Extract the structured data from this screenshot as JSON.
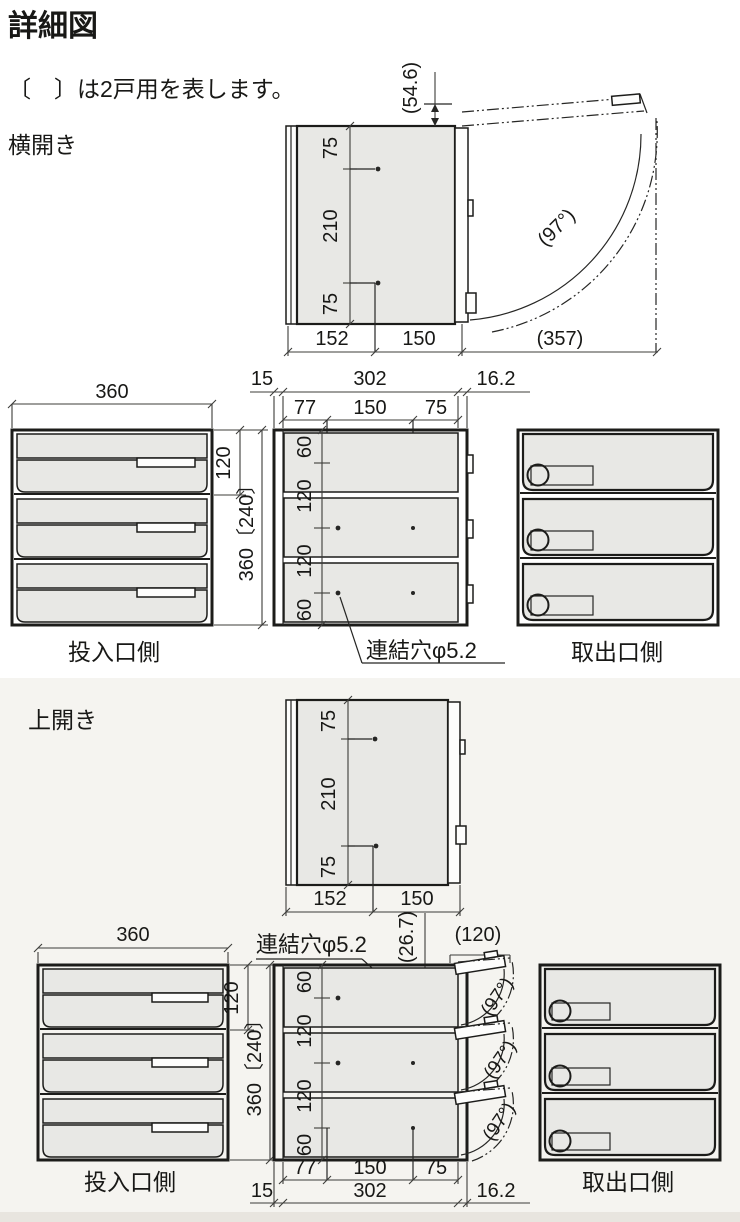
{
  "header": {
    "title": "詳細図",
    "note": "〔　〕は2戸用を表します。"
  },
  "sections": {
    "side_open": "横開き",
    "top_open": "上開き"
  },
  "labels": {
    "inlet_side": "投入口側",
    "outlet_side": "取出口側",
    "joint_hole": "連結穴φ5.2"
  },
  "dims": {
    "d54_6": "(54.6)",
    "d75": "75",
    "d210": "210",
    "d152": "152",
    "d150": "150",
    "d357": "(357)",
    "d97": "(97°)",
    "d360": "360",
    "d120": "120",
    "d360_240": "360〔240〕",
    "d15": "15",
    "d302": "302",
    "d16_2": "16.2",
    "d77": "77",
    "d60": "60",
    "d26_7": "(26.7)",
    "d120p": "(120)"
  },
  "colors": {
    "line": "#1c1c1a",
    "dimension": "#3c3c3a",
    "panel_gray": "#e8e8e5",
    "upper_bg": "#ffffff",
    "lower_bg": "#f5f4f0",
    "bottom_strip": "#e8e5df"
  }
}
